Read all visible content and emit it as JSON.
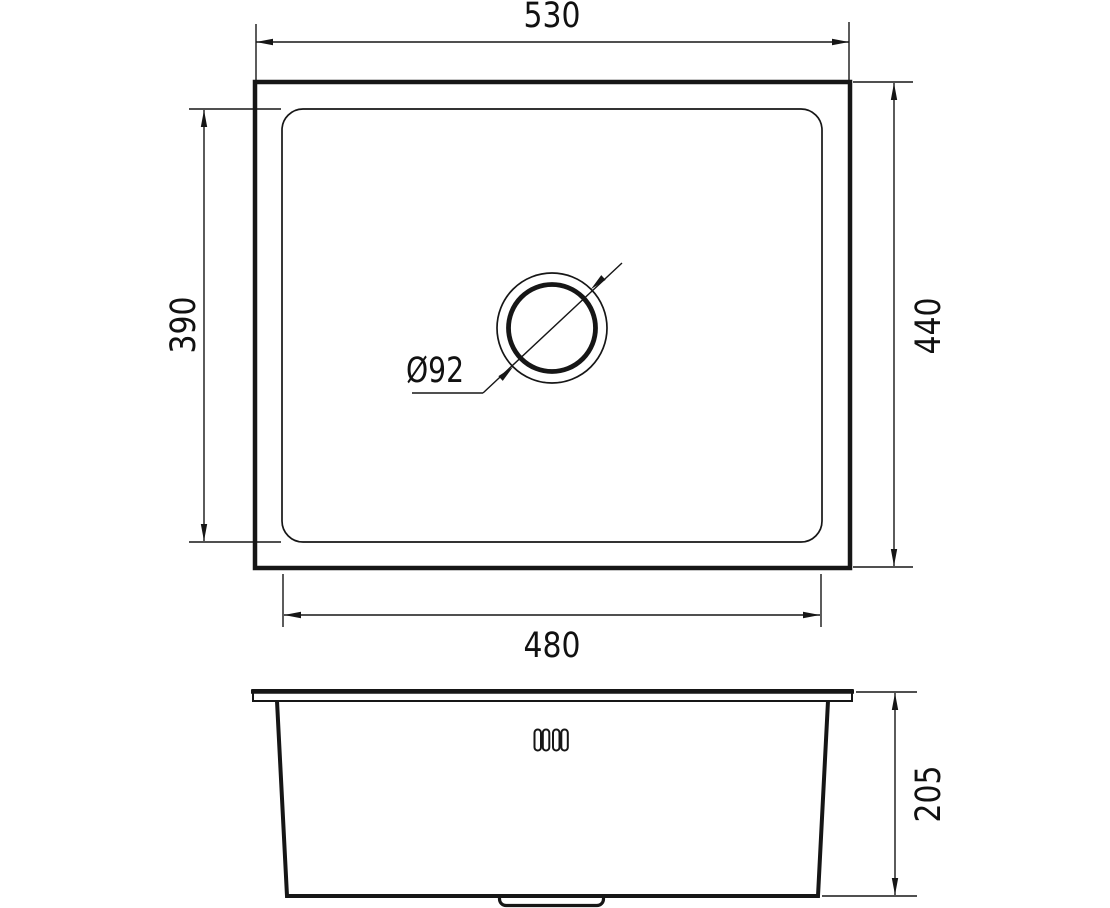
{
  "drawing": {
    "top_view": {
      "width_label": "530",
      "height_label": "440",
      "bowl_height_label": "390",
      "bowl_width_label": "480",
      "drain_diameter_label": "Ø92"
    },
    "side_view": {
      "depth_label": "205"
    },
    "colors": {
      "line": "#161616",
      "background": "#ffffff"
    }
  }
}
